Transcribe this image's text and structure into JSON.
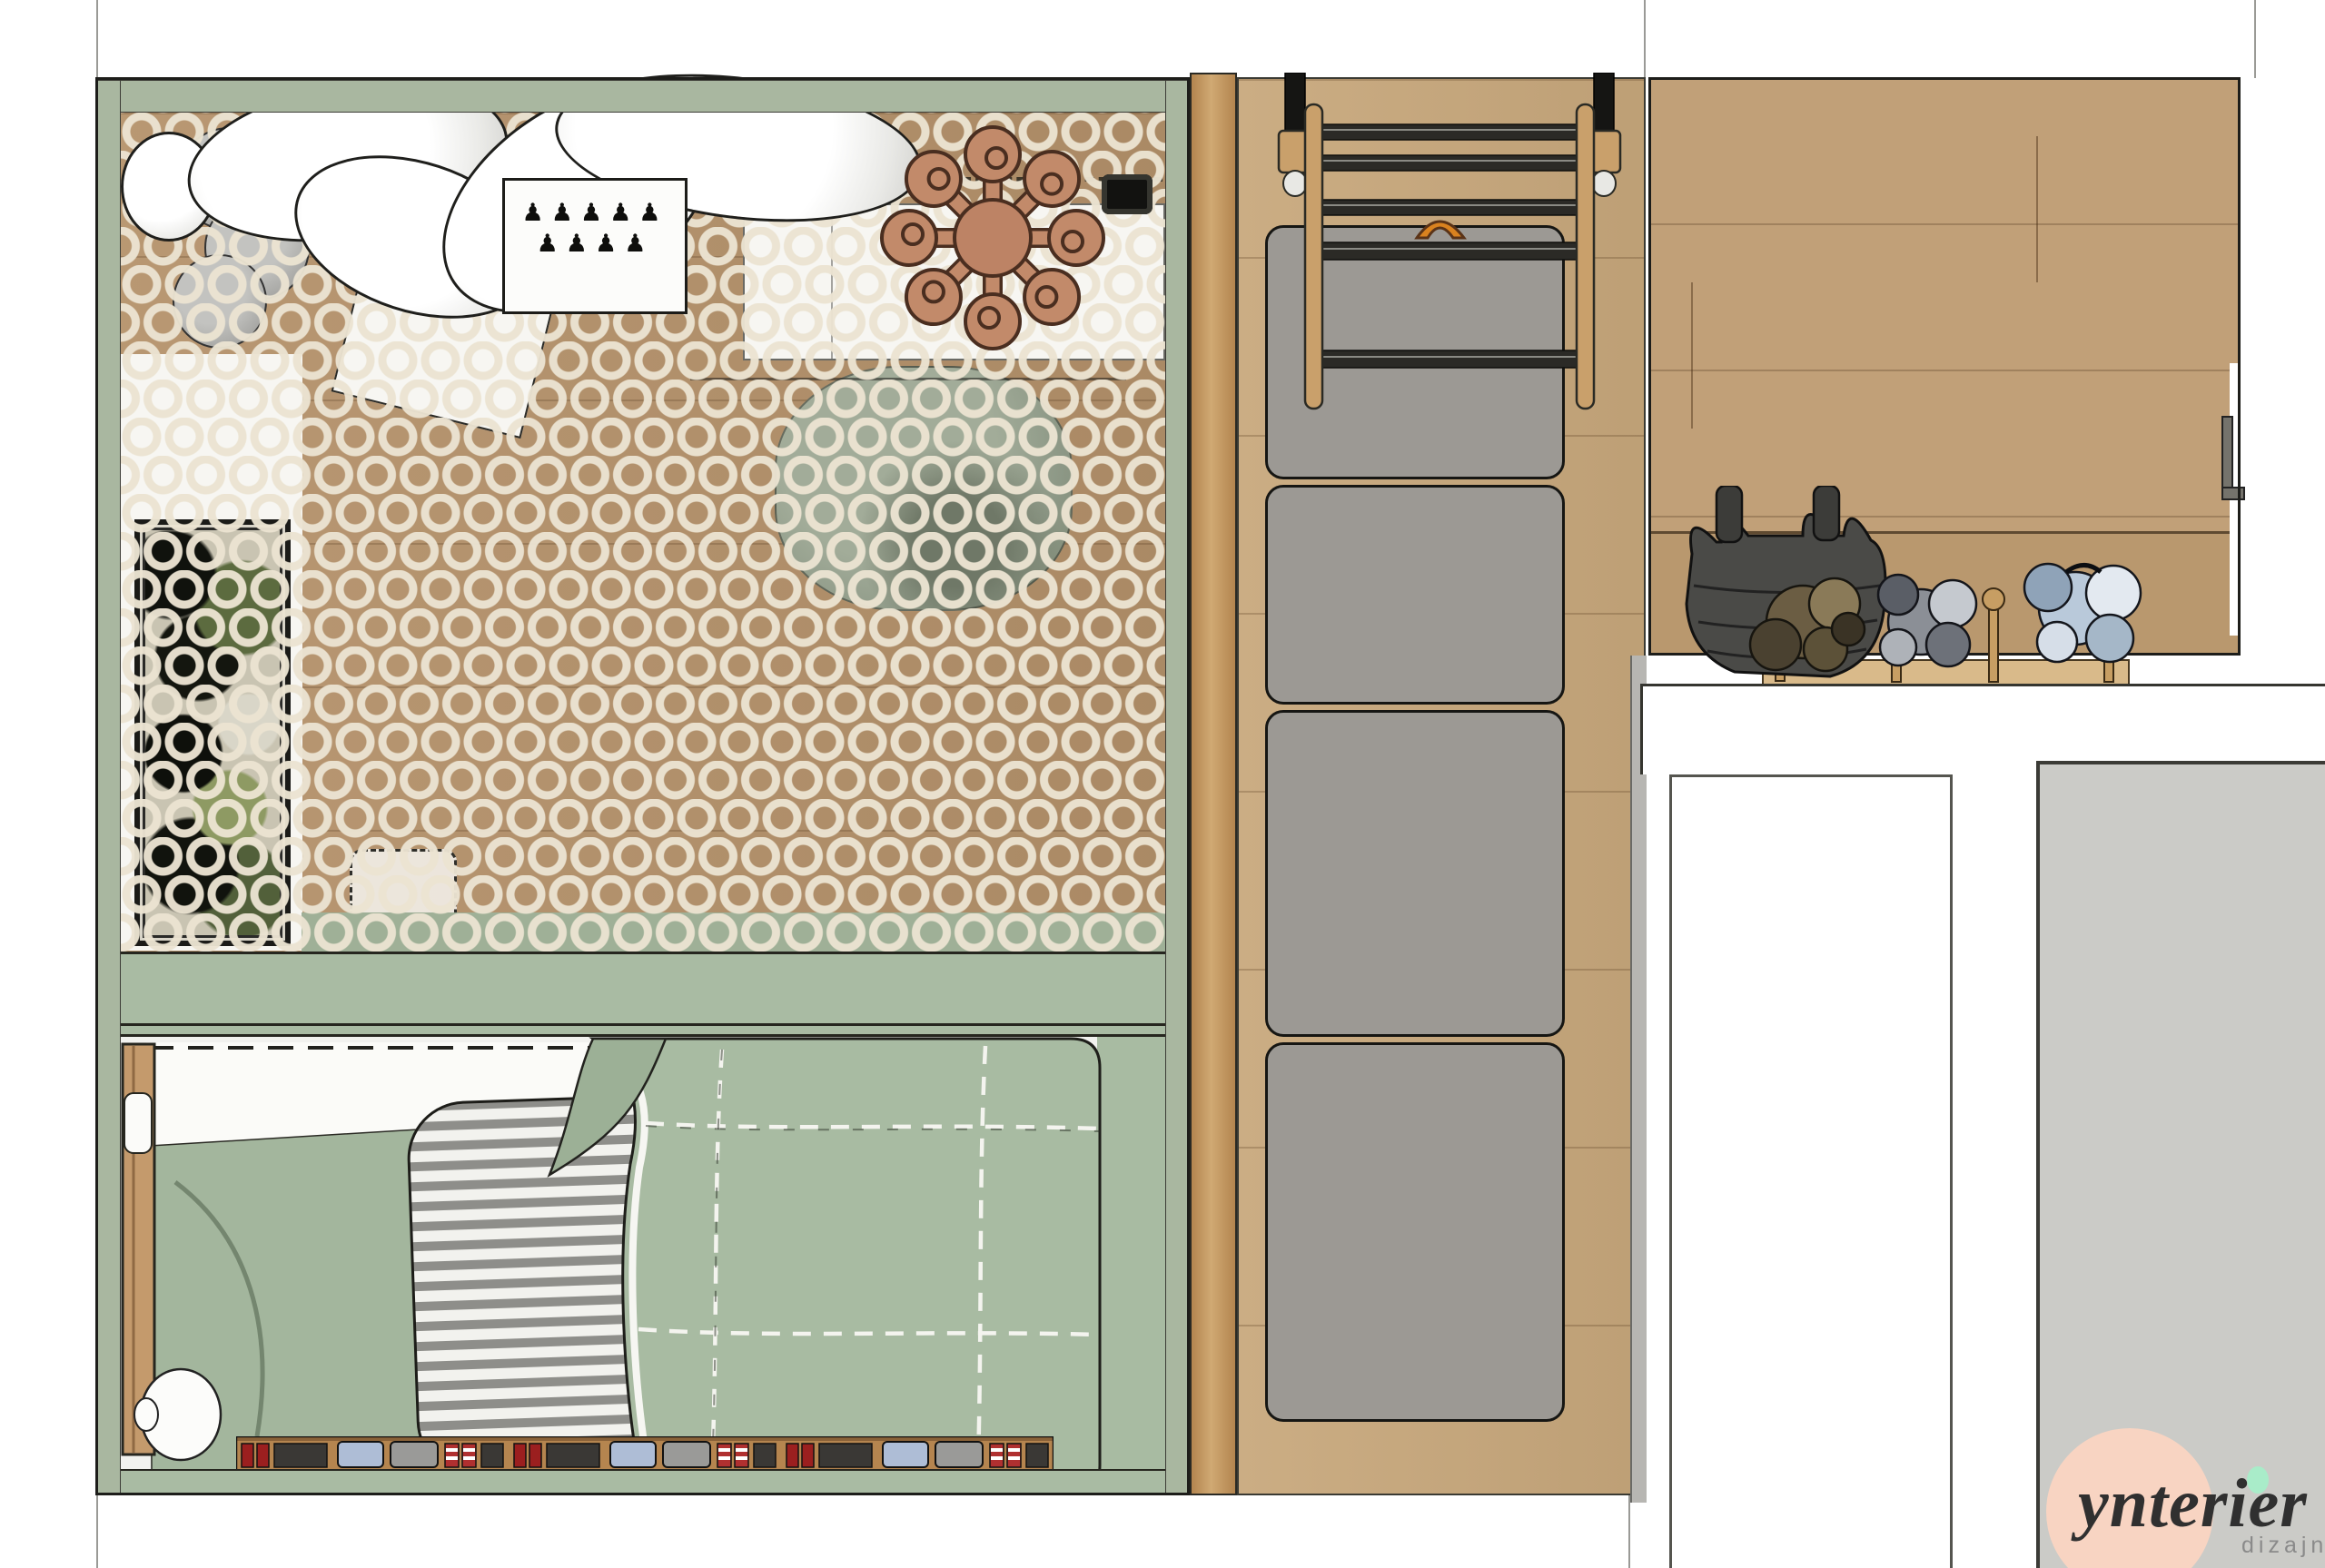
{
  "logo": {
    "brand": "ynterier",
    "subtitle": "dizajn"
  },
  "board_glyphs_row1": "♟♟♟♟♟",
  "board_glyphs_row2": "♟♟♟♟",
  "colors": {
    "wall-green": "#a9b7a0",
    "divider-green": "#a9bba3",
    "duvet-green": "#a8bba2",
    "fold-green": "#a3b69d",
    "chair-green": "#97a291",
    "sage-shadow": "#9fb097",
    "wood-left": "#b5926b",
    "wood-pillar": "#c2945f",
    "wood-mid": "#c8a87c",
    "wood-right": "#c1a078",
    "wood-bench": "#b9986e",
    "wood-shelf": "#d9ba8a",
    "rug-cream": "#ece4d2",
    "mat-gray": "#9c9994",
    "ink": "#1d1d1a",
    "counter-gray": "#cbcbc7",
    "side-gray": "#b7b6b2",
    "terracotta": "#c28a6a",
    "logo-pink": "#f8d4c2",
    "logo-mint": "#a9ecc9",
    "logo-ink": "#303030",
    "text-gray": "#8a8a8a",
    "book-red": "#9b1f1f",
    "book-blue": "#aebdd6",
    "paper-white": "#f7f6f2"
  },
  "scene": {
    "mat_segments": 4,
    "ladder_rungs": 5,
    "pillow_count": 5,
    "book_row_segments": 3
  }
}
